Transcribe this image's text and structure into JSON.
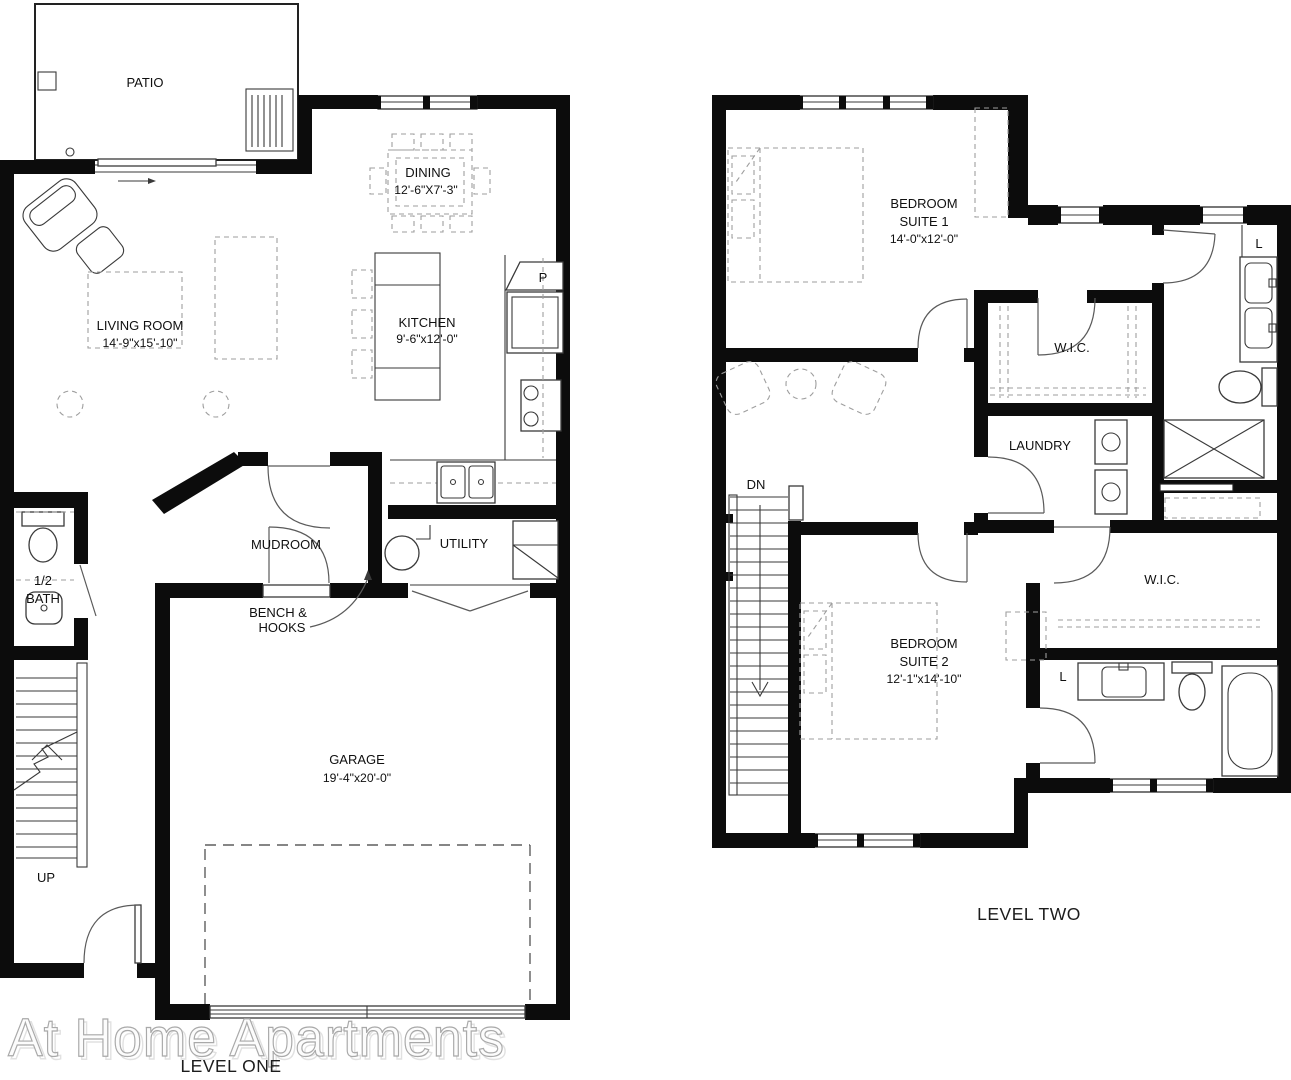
{
  "watermark": "At Home Apartments",
  "colors": {
    "wall": "#0c0c0c",
    "thin_line": "#3a3a3a",
    "furniture_dash": "#9e9e9e",
    "watermark_stroke": "#a9a9a9"
  },
  "level_one": {
    "caption": "LEVEL ONE",
    "patio": "PATIO",
    "living_room": {
      "name": "LIVING ROOM",
      "dims": "14'-9\"x15'-10\""
    },
    "dining": {
      "name": "DINING",
      "dims": "12'-6\"X7'-3\""
    },
    "kitchen": {
      "name": "KITCHEN",
      "dims": "9'-6\"x12'-0\""
    },
    "pantry": "P",
    "mudroom": "MUDROOM",
    "bench_line1": "BENCH &",
    "bench_line2": "HOOKS",
    "utility": "UTILITY",
    "half_bath_line1": "1/2",
    "half_bath_line2": "BATH",
    "garage": {
      "name": "GARAGE",
      "dims": "19'-4\"x20'-0\""
    },
    "stairs": "UP"
  },
  "level_two": {
    "caption": "LEVEL TWO",
    "suite1": {
      "line1": "BEDROOM",
      "line2": "SUITE 1",
      "dims": "14'-0\"x12'-0\""
    },
    "suite2": {
      "line1": "BEDROOM",
      "line2": "SUITE 2",
      "dims": "12'-1\"x14'-10\""
    },
    "wic1": "W.I.C.",
    "wic2": "W.I.C.",
    "laundry": "LAUNDRY",
    "linen1": "L",
    "linen2": "L",
    "stairs": "DN"
  }
}
